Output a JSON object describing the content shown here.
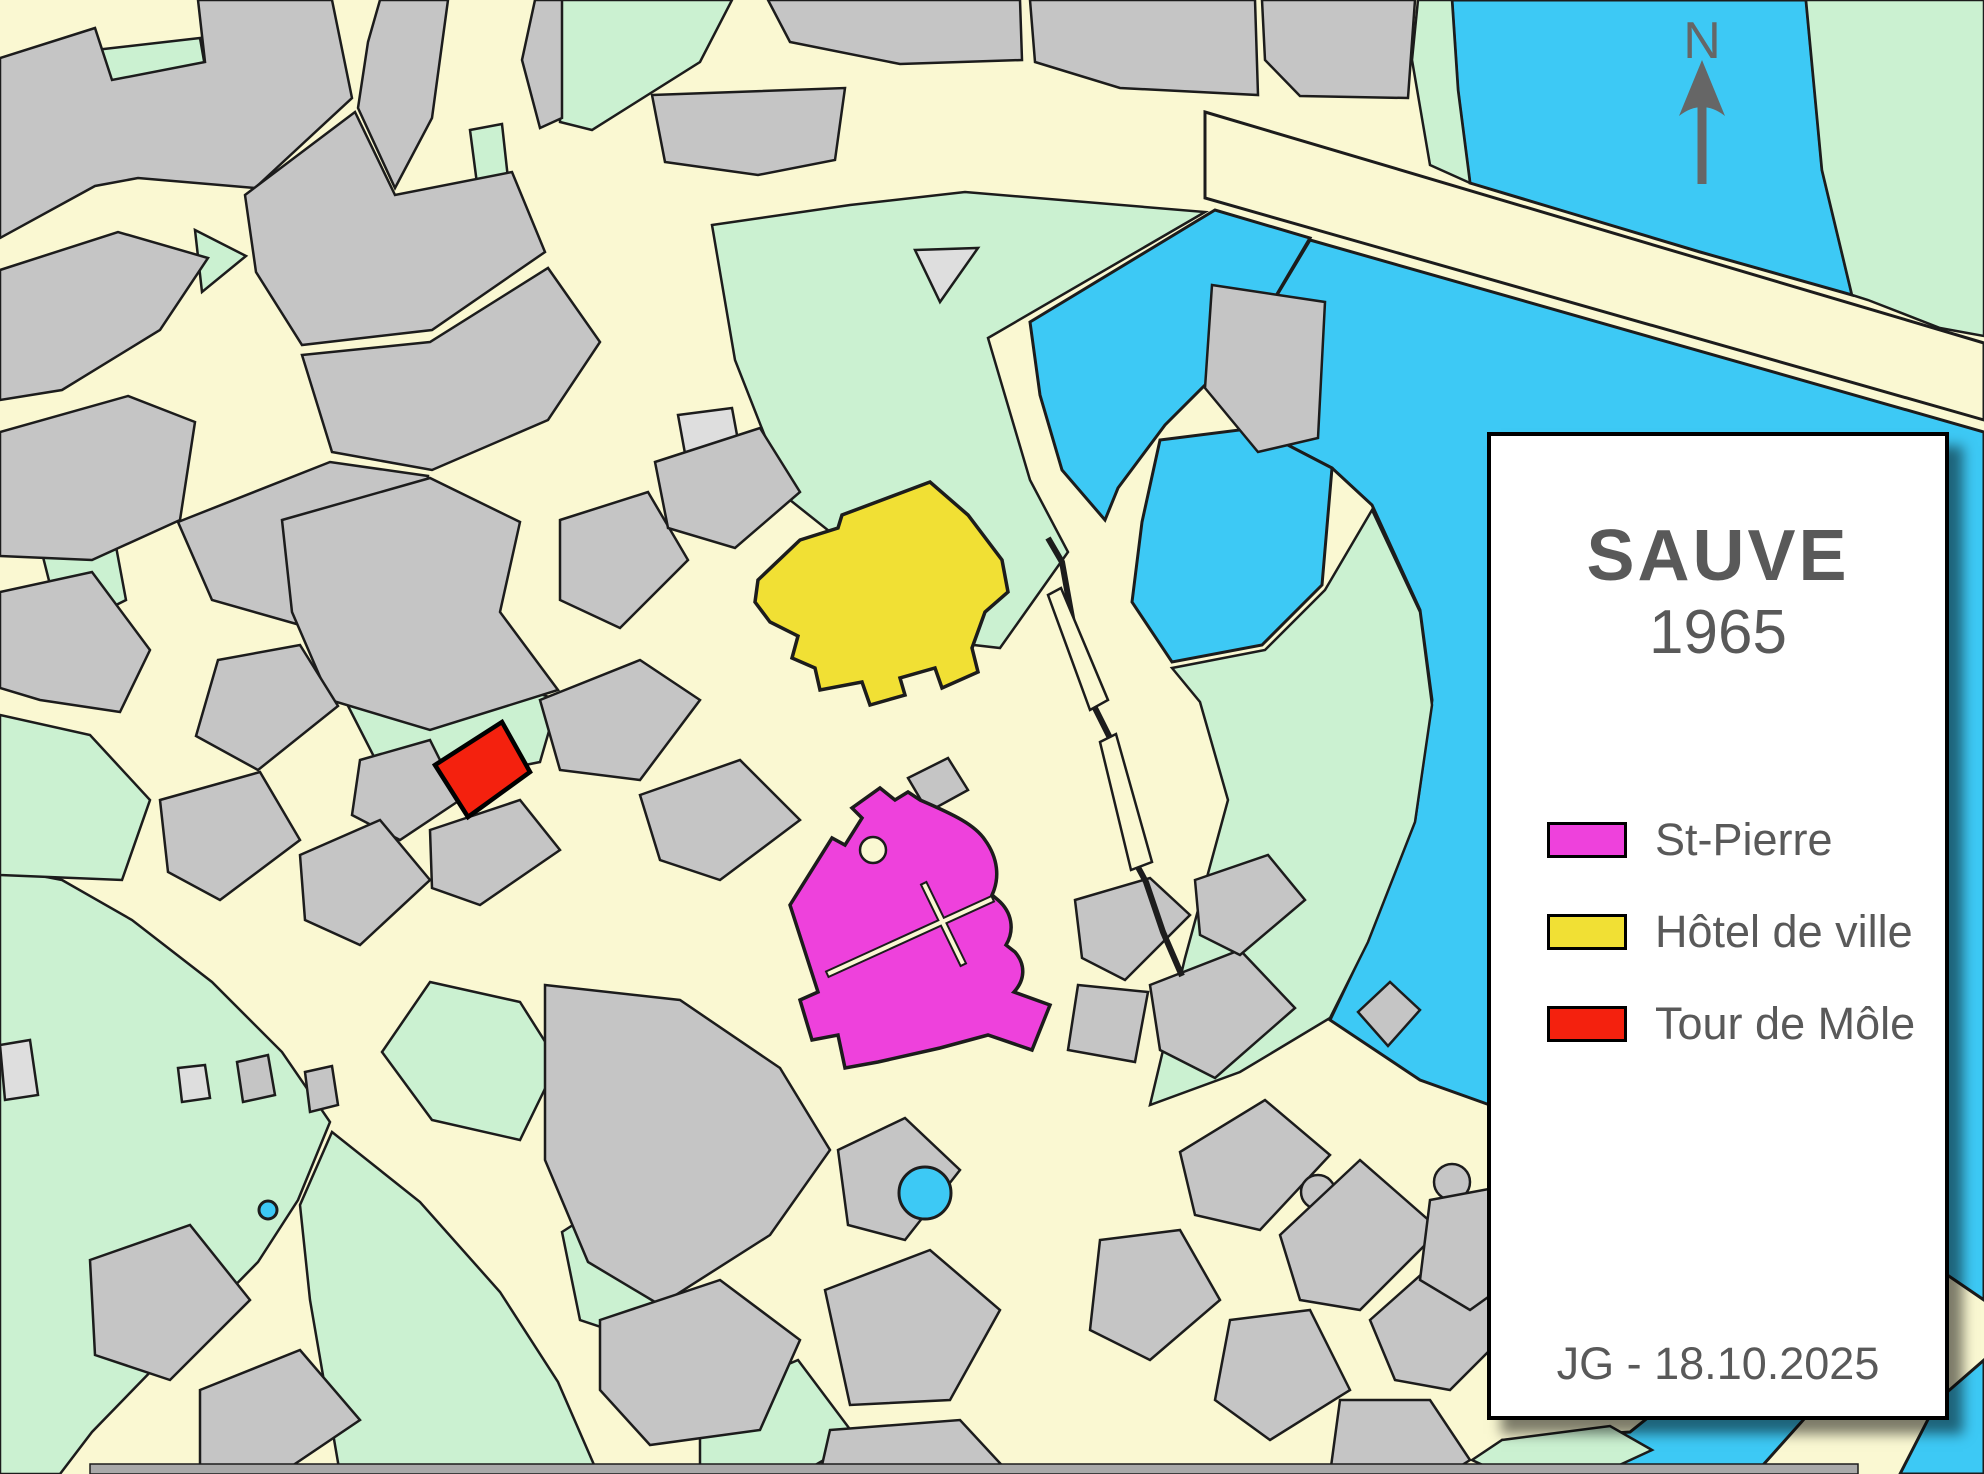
{
  "legend": {
    "title": "SAUVE",
    "year": "1965",
    "items": [
      {
        "label": "St-Pierre",
        "color": "#EE41DC"
      },
      {
        "label": "Hôtel de ville",
        "color": "#F1E034"
      },
      {
        "label": "Tour de Môle",
        "color": "#F4210E"
      }
    ],
    "credit": "JG - 18.10.2025"
  },
  "north": {
    "label": "N"
  },
  "map": {
    "palette": {
      "street": "#FAF8D2",
      "building": "#C5C5C5",
      "buildingLight": "#DEDEDE",
      "green": "#CBF1D1",
      "water": "#3DC9F5",
      "outline": "#1C1C1C",
      "magenta": "#EE41DC",
      "yellow": "#F1E034",
      "red": "#F4210E",
      "text": "#595959",
      "arrow": "#666666"
    },
    "layers": [
      {
        "name": "water",
        "cls": "water",
        "items": [
          {
            "points": "1452,0 1806,0 1822,170 1852,295 1700,252 1560,210 1470,183 1458,90",
            "name": "river-north"
          },
          {
            "points": "1310,240 1984,432 1984,1300 1940,1270 1845,1255 1610,1148 1420,1080 1330,1020 1368,940 1415,820 1432,700 1420,610 1372,505 1332,468 1255,428 1250,340",
            "name": "river-east"
          },
          {
            "points": "1984,1360 1984,1474 1900,1474 1938,1400",
            "name": "river-corner"
          },
          {
            "points": "1505,1440 1630,1432 1705,1372 1800,1292 1845,1262 1902,1306 1830,1390 1755,1474 1545,1474",
            "name": "river-south"
          },
          {
            "points": "1030,322 1215,210 1310,238 1250,340 1165,425 1118,488 1105,520 1062,470 1040,395",
            "name": "river-arm"
          },
          {
            "points": "1160,440 1255,428 1332,468 1322,585 1262,645 1172,662 1132,602 1142,522",
            "name": "pond"
          }
        ]
      },
      {
        "name": "green",
        "cls": "green",
        "items": [
          {
            "points": "712,225 850,205 965,192 1205,212 988,338 1030,480 1068,552 1000,648 930,640 868,562 790,500 735,360"
          },
          {
            "points": "1172,668 1265,650 1325,590 1372,510 1420,612 1432,705 1415,822 1368,942 1330,1018 1240,1072 1150,1105 1185,958 1228,800 1200,702"
          },
          {
            "points": "1806,0 1984,0 1984,336 1940,328 1868,300 1852,295 1822,170"
          },
          {
            "points": "0,868 62,880 132,920 212,982 282,1052 330,1122 298,1200 258,1262 160,1362 92,1432 60,1474 0,1474"
          },
          {
            "points": "332,1132 420,1202 500,1292 558,1382 598,1474 340,1474 310,1300 300,1205"
          },
          {
            "points": "430,982 520,1002 558,1062 520,1140 432,1120 382,1052"
          },
          {
            "points": "562,1232 640,1182 700,1262 640,1340 580,1320"
          },
          {
            "points": "700,1402 798,1360 858,1440 800,1474 700,1474"
          },
          {
            "points": "1502,1440 1610,1426 1652,1450 1600,1474 1502,1474 1472,1460"
          },
          {
            "points": "95,50 200,38 210,95 105,108"
          },
          {
            "points": "40,545 112,525 126,600 62,632"
          },
          {
            "points": "0,715 90,735 150,800 122,880 0,875"
          },
          {
            "points": "345,700 498,680 558,700 540,762 392,792"
          },
          {
            "points": "470,130 502,124 512,215 482,222"
          },
          {
            "points": "195,230 246,256 202,292"
          },
          {
            "points": "290,178 332,172 336,220 296,226"
          },
          {
            "points": "560,0 732,0 700,62 592,130 560,122"
          },
          {
            "points": "1418,0 1452,0 1458,90 1470,183 1430,165 1412,60"
          }
        ]
      },
      {
        "name": "building-light",
        "cls": "bldl",
        "items": [
          {
            "points": "678,415 732,408 742,462 688,470"
          },
          {
            "points": "915,250 978,248 940,302"
          },
          {
            "points": "0,1045 30,1040 38,1095 5,1100"
          },
          {
            "points": "178,1068 205,1065 210,1098 182,1102"
          },
          {
            "points": "62,430 82,425 88,490 68,495"
          }
        ]
      },
      {
        "name": "building",
        "cls": "bld",
        "items": [
          {
            "points": "0,58 95,28 112,80 205,62 198,0 332,0 352,98 255,188 138,178 95,186 0,238"
          },
          {
            "points": "380,0 448,0 432,118 395,188 358,108 368,42"
          },
          {
            "points": "535,0 562,0 562,118 540,128 522,60"
          },
          {
            "points": "652,95 845,88 835,160 758,175 665,162"
          },
          {
            "points": "768,0 1020,0 1022,60 900,64 790,42"
          },
          {
            "points": "1030,0 1255,0 1258,95 1120,88 1035,62"
          },
          {
            "points": "1262,0 1415,0 1408,98 1300,96 1265,60"
          },
          {
            "points": "0,270 118,232 208,258 160,330 62,390 0,400"
          },
          {
            "points": "0,432 128,396 195,422 180,520 92,560 0,556"
          },
          {
            "points": "0,592 92,572 150,650 120,712 40,700 0,688"
          },
          {
            "points": "245,195 355,112 395,195 512,172 545,252 432,330 302,345 256,272"
          },
          {
            "points": "302,355 430,342 548,268 600,342 548,420 432,470 332,452"
          },
          {
            "points": "178,522 330,462 428,476 418,570 300,625 212,600"
          },
          {
            "points": "282,520 430,478 520,522 500,612 558,690 430,730 330,700 292,612"
          },
          {
            "points": "560,520 648,492 688,560 620,628 560,600"
          },
          {
            "points": "655,462 760,428 800,492 735,548 668,528"
          },
          {
            "points": "540,700 640,660 700,700 640,780 560,770"
          },
          {
            "points": "640,795 740,760 800,820 720,880 660,860"
          },
          {
            "points": "430,830 520,800 560,850 480,905 432,888"
          },
          {
            "points": "360,760 430,740 460,800 400,840 352,815"
          },
          {
            "points": "218,660 300,645 338,706 258,770 196,736"
          },
          {
            "points": "160,800 260,772 300,840 220,900 168,872"
          },
          {
            "points": "300,855 380,820 430,880 360,945 305,920"
          },
          {
            "points": "1212,285 1325,302 1318,438 1258,452 1205,388"
          },
          {
            "points": "908,778 948,758 968,790 928,812"
          },
          {
            "points": "1075,900 1150,878 1190,915 1125,980 1082,958"
          },
          {
            "points": "1150,985 1240,950 1295,1008 1215,1078 1160,1050"
          },
          {
            "points": "1078,985 1148,992 1135,1062 1068,1050"
          },
          {
            "points": "1195,880 1268,855 1305,900 1240,955 1200,935"
          },
          {
            "points": "545,985 680,1000 780,1068 830,1150 770,1235 660,1305 588,1262 545,1160"
          },
          {
            "points": "600,1320 720,1280 800,1340 760,1430 650,1445 600,1390"
          },
          {
            "points": "825,1290 930,1250 1000,1310 950,1400 850,1405"
          },
          {
            "points": "830,1430 960,1420 1010,1474 820,1474"
          },
          {
            "points": "838,1150 905,1118 960,1170 905,1240 848,1225"
          },
          {
            "points": "1100,1240 1180,1230 1220,1300 1150,1360 1090,1330"
          },
          {
            "points": "1180,1152 1265,1100 1330,1155 1260,1230 1195,1215"
          },
          {
            "cx": 1318,
            "cy": 1192,
            "r": 17,
            "name": "round-tower"
          },
          {
            "points": "1280,1235 1360,1160 1440,1230 1360,1310 1300,1300"
          },
          {
            "points": "1370,1320 1460,1240 1530,1310 1450,1390 1395,1380"
          },
          {
            "points": "1230,1320 1310,1310 1350,1390 1270,1440 1215,1400"
          },
          {
            "points": "1340,1400 1430,1400 1470,1460 1448,1474 1330,1474"
          },
          {
            "cx": 1452,
            "cy": 1182,
            "r": 18,
            "name": "round-tower"
          },
          {
            "points": "1430,1200 1510,1185 1540,1260 1470,1310 1420,1280"
          },
          {
            "points": "1358,1012 1390,982 1420,1010 1388,1046"
          },
          {
            "points": "90,1260 190,1225 250,1300 170,1380 95,1355"
          },
          {
            "points": "200,1390 300,1350 360,1420 280,1474 200,1474"
          },
          {
            "points": "237,1062 268,1055 275,1095 243,1102"
          },
          {
            "points": "305,1072 332,1066 338,1105 310,1112"
          }
        ]
      },
      {
        "name": "road",
        "cls": "road",
        "items": [
          {
            "points": "1205,112 1984,343 1984,420 1205,198",
            "name": "bridge-road"
          }
        ]
      },
      {
        "name": "rampart",
        "cls": "wall",
        "items": [
          {
            "poly": "1048,538 1062,562 1076,640 1092,702 1104,726 1114,746 1132,856 1146,882 1163,932 1182,976",
            "name": "rampart-wall"
          }
        ]
      },
      {
        "name": "sliver",
        "cls": "sliver",
        "items": [
          {
            "points": "1048,595 1061,588 1108,700 1090,710",
            "name": "stair-strip"
          },
          {
            "points": "1100,742 1116,734 1152,862 1131,870",
            "name": "stair-strip"
          }
        ]
      },
      {
        "name": "highlight",
        "cls": "",
        "items": [
          {
            "points": "758,580 800,540 838,528 842,515 930,482 968,515 1002,560 1008,592 985,612 972,648 978,672 942,688 935,668 900,678 905,695 870,705 862,682 820,690 815,668 792,658 798,636 770,622 755,602",
            "cls": "hl-yellow",
            "name": "hotel-de-ville-building"
          },
          {
            "path": "M790,905 L832,838 L845,845 L862,818 L852,808 L880,788 L895,800 L908,792 L920,800 C955,815 975,825 985,840 C998,858 1000,878 992,895 L998,900 C1012,912 1015,930 1006,945 L1015,952 C1026,965 1025,980 1014,992 L1050,1005 L1032,1050 L988,1035 L940,1048 L878,1062 L845,1068 L838,1035 L812,1040 L800,1000 L818,992 Z",
            "cls": "hl-magenta",
            "name": "st-pierre-church"
          },
          {
            "points": "435,765 502,722 530,772 468,817",
            "cls": "hl-red",
            "name": "tour-de-mole-building"
          }
        ]
      },
      {
        "name": "detail",
        "cls": "",
        "items": [
          {
            "cx": 873,
            "cy": 850,
            "r": 13,
            "cls": "hole",
            "name": "church-courtyard"
          },
          {
            "x1": 830,
            "y1": 973,
            "x2": 990,
            "y2": 900,
            "cls": "cross-bk",
            "name": "church-cross"
          },
          {
            "x1": 925,
            "y1": 886,
            "x2": 962,
            "y2": 962,
            "cls": "cross-bk",
            "name": "church-cross"
          },
          {
            "x1": 830,
            "y1": 973,
            "x2": 990,
            "y2": 900,
            "cls": "cross-cr",
            "name": "church-cross"
          },
          {
            "x1": 925,
            "y1": 886,
            "x2": 962,
            "y2": 962,
            "cls": "cross-cr",
            "name": "church-cross"
          },
          {
            "cx": 925,
            "cy": 1193,
            "r": 26,
            "cls": "pond",
            "name": "fountain-pond"
          },
          {
            "cx": 268,
            "cy": 1210,
            "r": 9,
            "cls": "pond",
            "name": "small-fountain"
          },
          {
            "points": "90,1464 1858,1464 1858,1474 90,1474",
            "cls": "bar",
            "name": "map-edge-strip"
          }
        ]
      }
    ]
  }
}
